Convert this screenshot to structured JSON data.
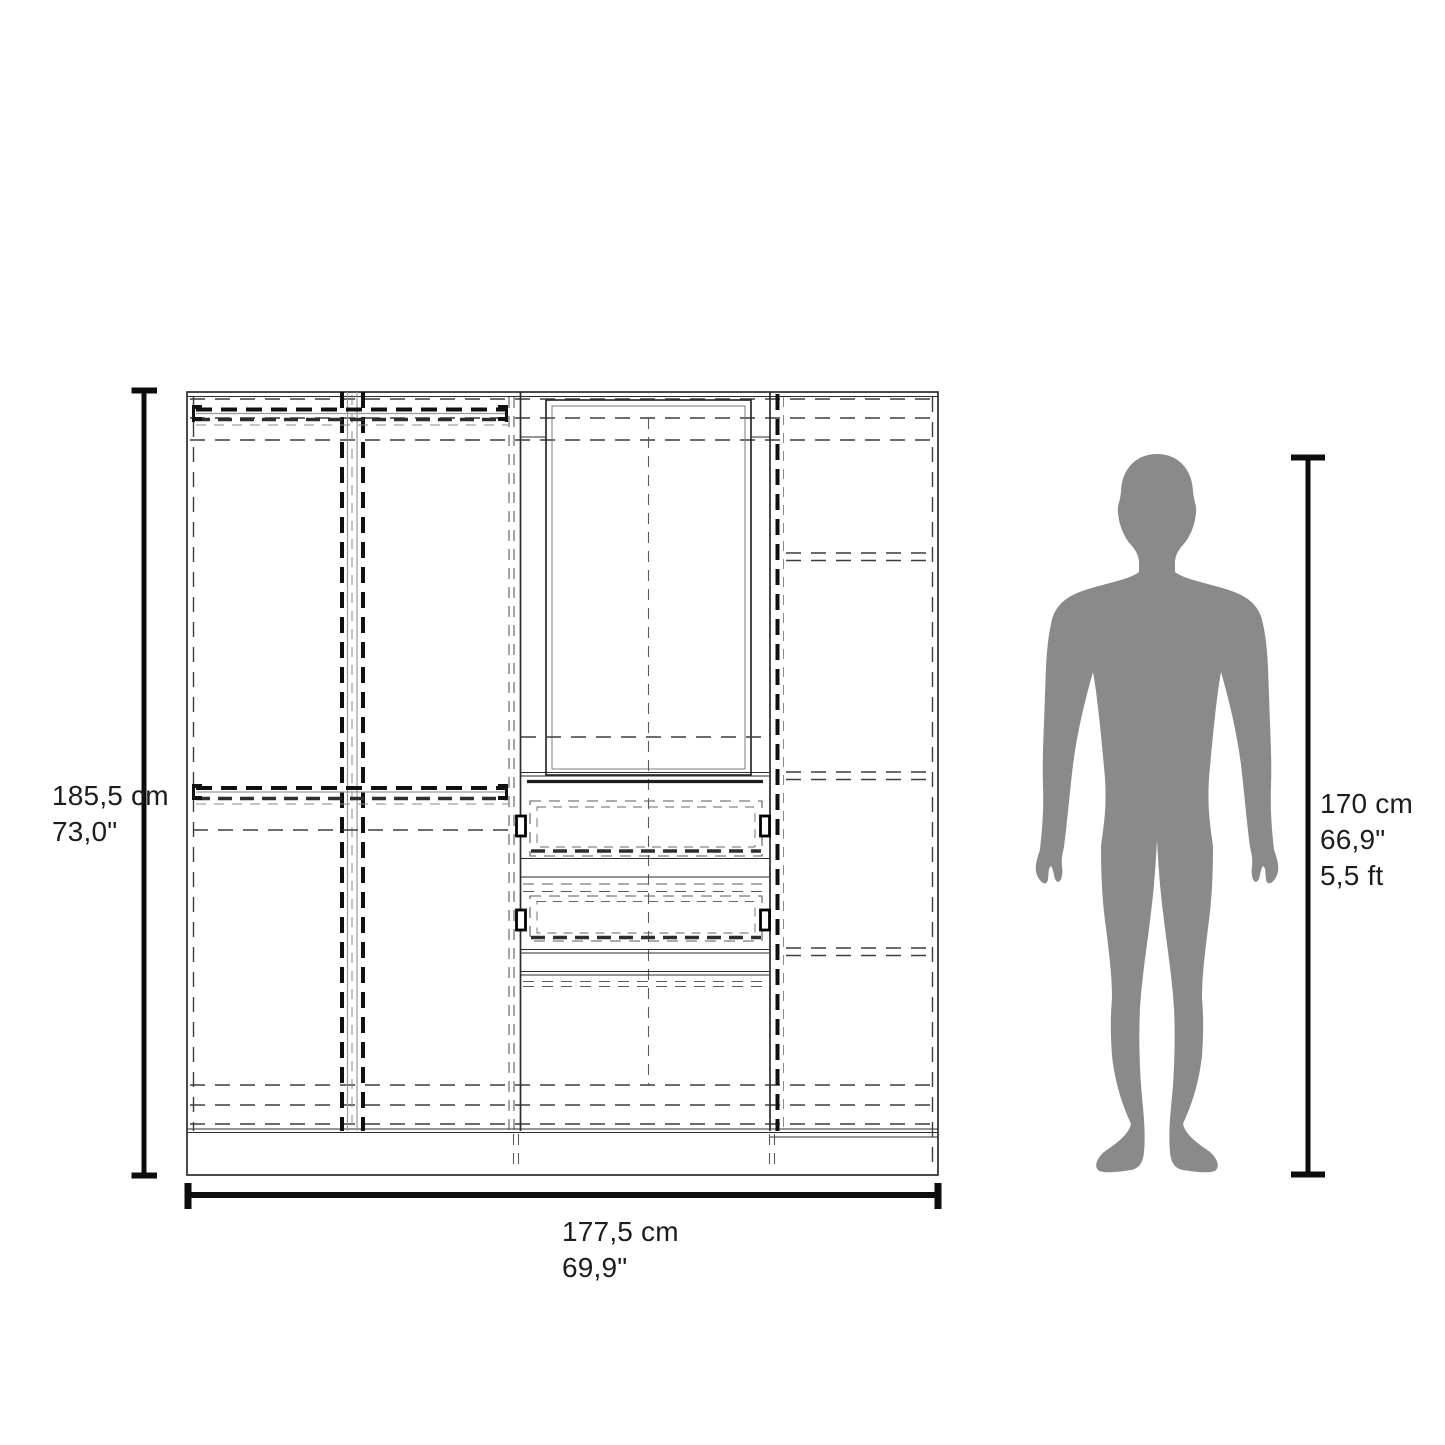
{
  "diagram": {
    "type": "furniture-dimension-diagram",
    "subject": "wardrobe front elevation with human figure for scale",
    "colors": {
      "background": "#ffffff",
      "line": "#2b2b2b",
      "dimension_line": "#0d0d0d",
      "silhouette": "#8a8a8a",
      "text": "#1d1d1f"
    },
    "wardrobe_height_label": {
      "cm": "185,5 cm",
      "inches": "73,0\""
    },
    "wardrobe_width_label": {
      "cm": "177,5 cm",
      "inches": "69,9\""
    },
    "person_height_label": {
      "cm": "170 cm",
      "inches": "66,9\"",
      "feet": "5,5 ft"
    }
  }
}
